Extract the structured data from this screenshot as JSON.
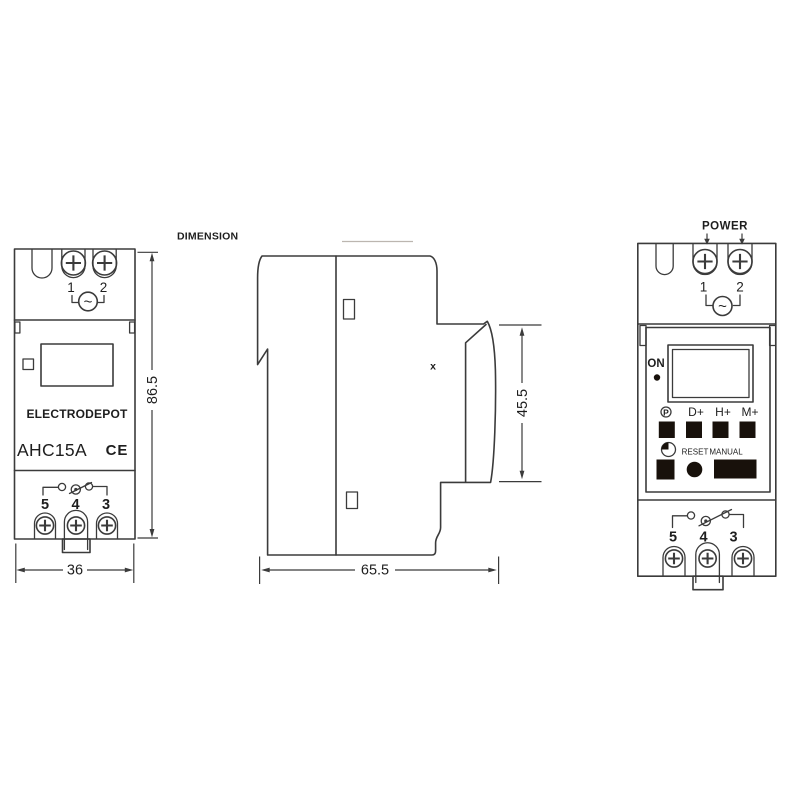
{
  "diagram": {
    "title": "DIMENSION",
    "marker": "x",
    "ac_symbol": "~"
  },
  "front_view": {
    "terminals_top": [
      "1",
      "2"
    ],
    "brand": "ELECTRODEPOT",
    "model": "AHC15A",
    "ce_mark": "CE",
    "terminals_bottom": [
      "5",
      "4",
      "3"
    ],
    "dim_width": "36",
    "dim_height": "86.5"
  },
  "side_view": {
    "dim_depth": "65.5",
    "dim_front_height": "45.5"
  },
  "panel_view": {
    "power_label": "POWER",
    "terminals_top": [
      "1",
      "2"
    ],
    "on_label": "ON",
    "program_button_label": "P",
    "day_button_label": "D+",
    "hour_button_label": "H+",
    "minute_button_label": "M+",
    "reset_label": "RESET",
    "manual_label": "MANUAL",
    "terminals_bottom": [
      "5",
      "4",
      "3"
    ]
  },
  "colors": {
    "line": "#3b3b3b",
    "button_fill": "#18110b",
    "text": "#1e1e1e",
    "background": "#ffffff"
  }
}
